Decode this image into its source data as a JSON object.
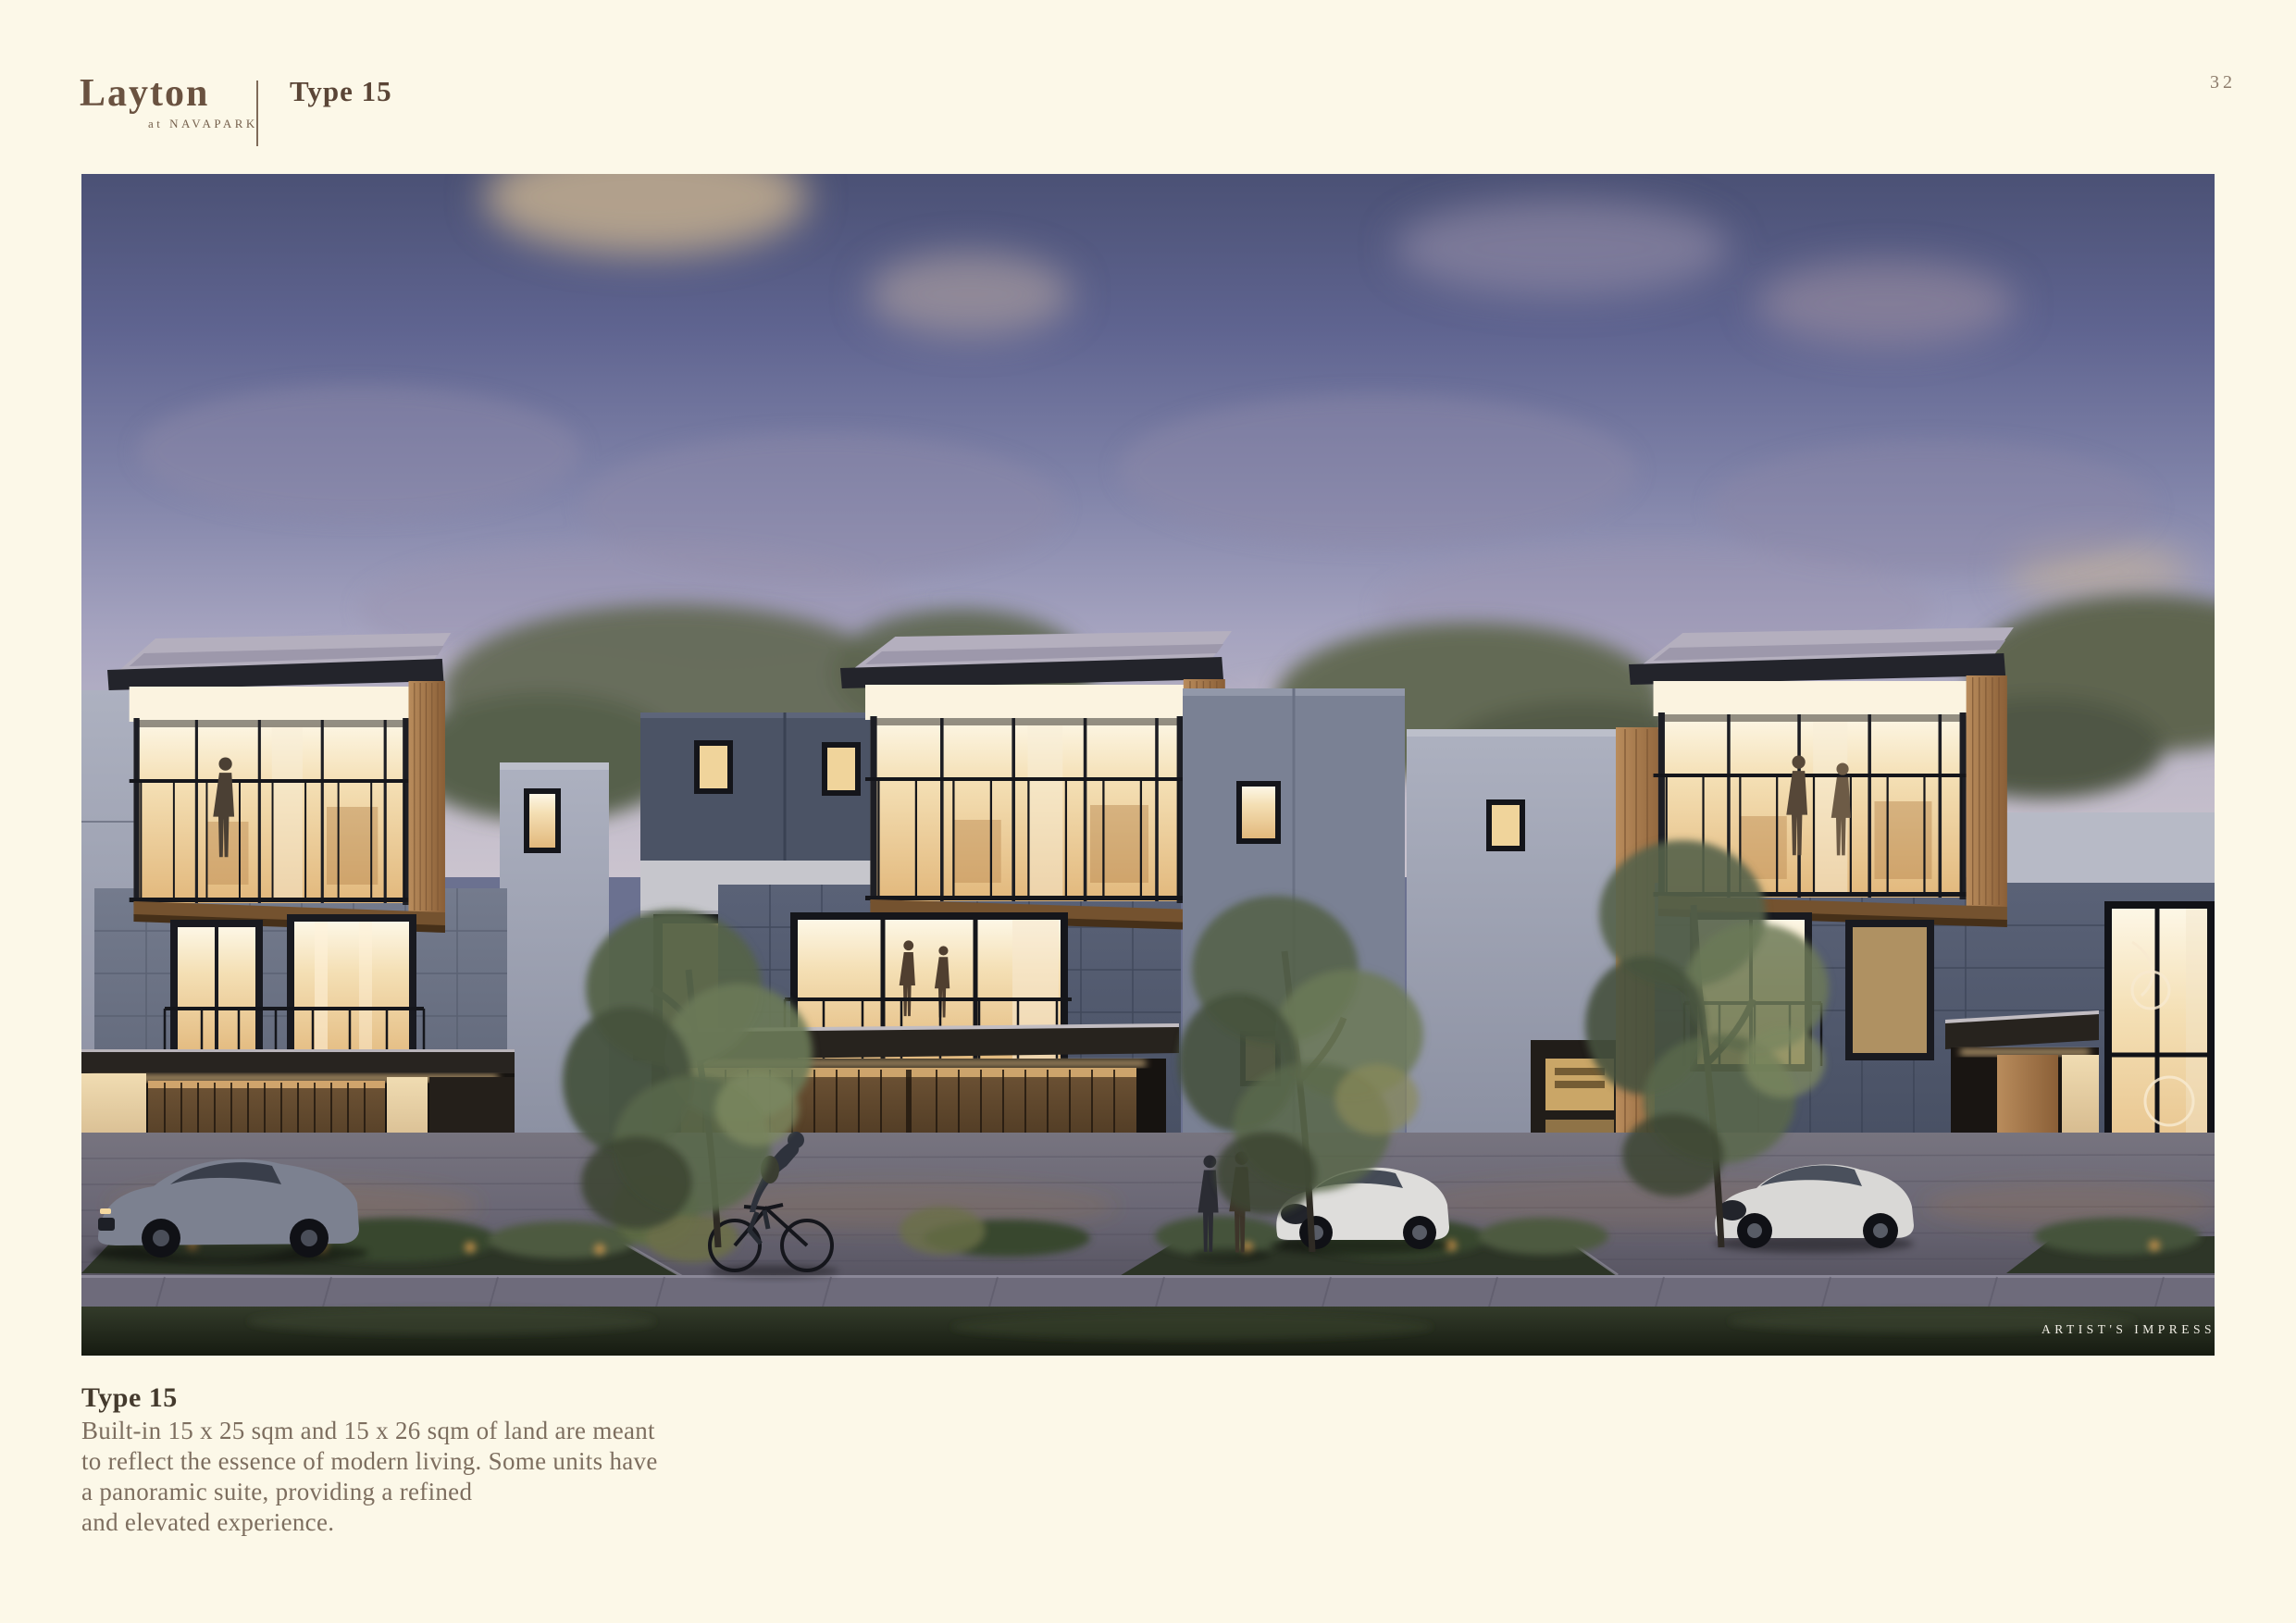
{
  "page": {
    "number": "32"
  },
  "header": {
    "brand": "Layton",
    "brand_tagline": "at NAVAPARK",
    "section": "Type 15"
  },
  "image": {
    "label": "ARTIST'S IMPRESSION",
    "description": "Dusk architectural rendering of three modern three-storey townhouses with cantilevered glass upper floors, warm lit interiors, trees, parked cars, a cyclist and residents"
  },
  "caption": {
    "title": "Type 15",
    "lines": [
      "Built-in 15 x 25 sqm and 15 x 26 sqm of land are meant",
      "to reflect the essence of modern living. Some units have",
      "a panoramic suite, providing a refined",
      "and elevated experience."
    ]
  },
  "palette": {
    "page_background": "#fcf8e8",
    "brand_brown": "#6a5240",
    "heading_brown": "#5a4536",
    "body_text": "#7d6e5f",
    "sky_top": "#4b5175",
    "sky_horizon": "#cbc4cf",
    "window_glow": "#f0d9a8",
    "wood": "#a87e52",
    "grass_dark": "#1c2118"
  }
}
